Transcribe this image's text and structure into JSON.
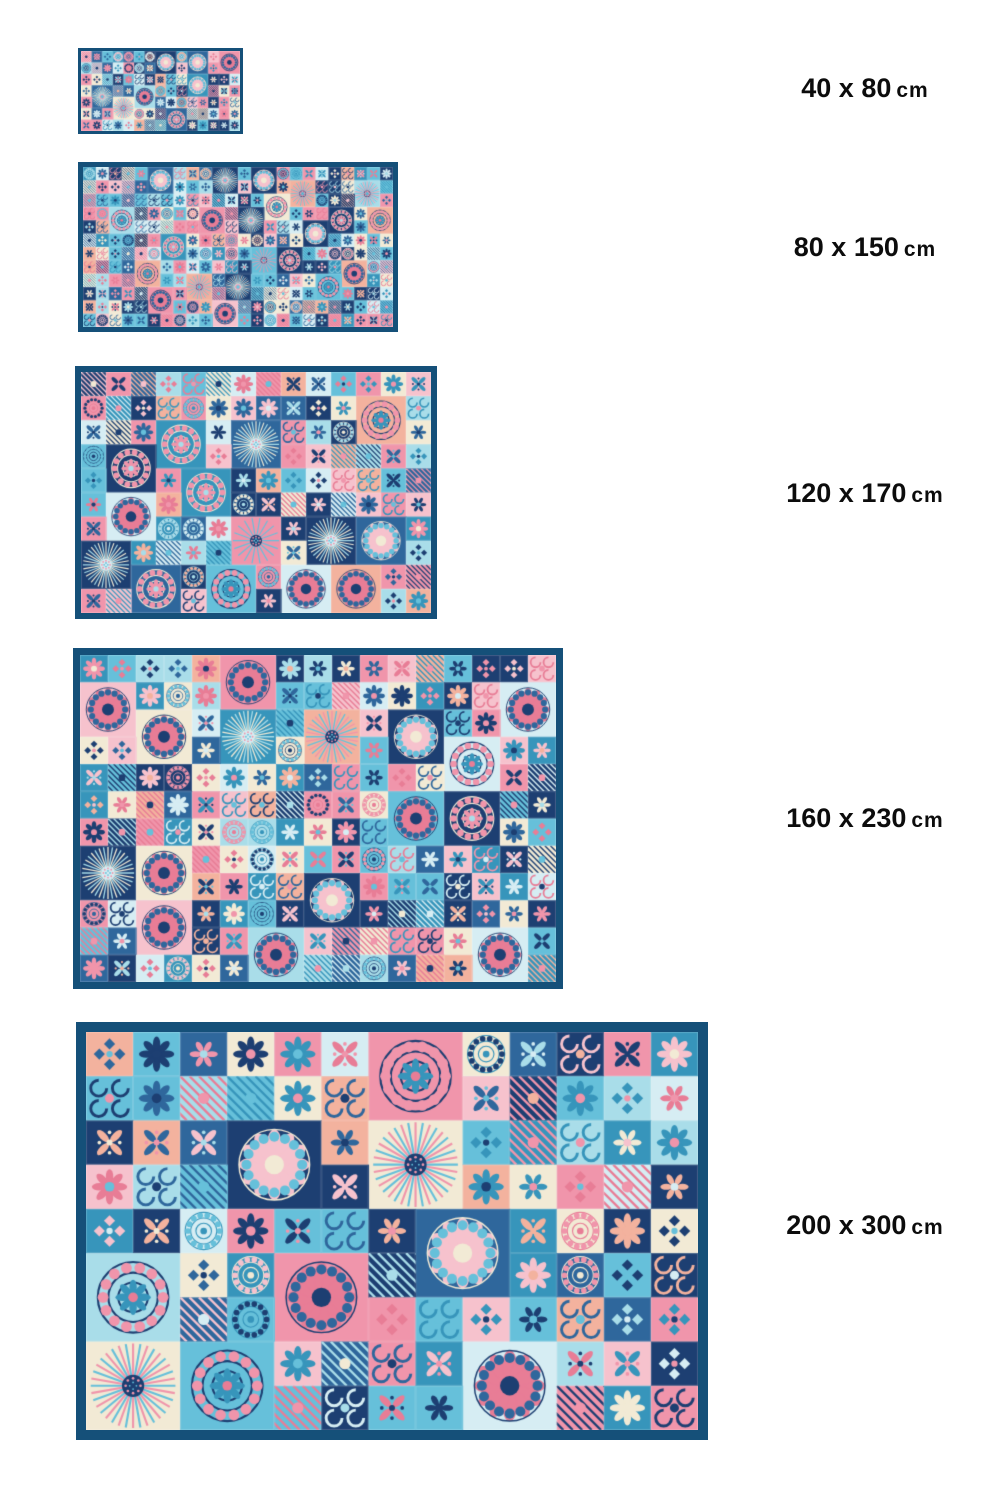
{
  "rugs": [
    {
      "size": "40 x 80",
      "unit": "cm"
    },
    {
      "size": "80 x 150",
      "unit": "cm"
    },
    {
      "size": "120 x 170",
      "unit": "cm"
    },
    {
      "size": "160 x 230",
      "unit": "cm"
    },
    {
      "size": "200 x 300",
      "unit": "cm"
    }
  ],
  "palette": {
    "page_background": "#ffffff",
    "label_text": "#0c0c0c",
    "rug_border": "#155079",
    "navy": "#1d3f72",
    "blue": "#2f679c",
    "teal": "#3795bb",
    "cyan": "#66c0da",
    "lightCyan": "#a9dde9",
    "paleBlue": "#d6edf3",
    "pink": "#f095ab",
    "lightPink": "#f6c2cd",
    "salmon": "#f3b29e",
    "cream": "#f2ead5",
    "coral": "#e87d96"
  }
}
